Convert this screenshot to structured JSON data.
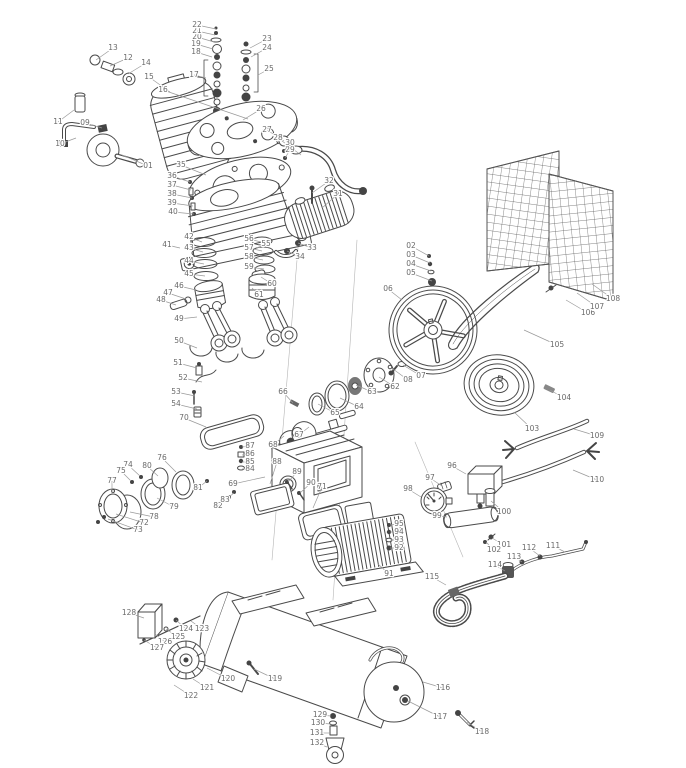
{
  "style": {
    "line_color": "#4a4a4a",
    "label_color": "#6a6a6a",
    "background": "#ffffff",
    "hardware_fill": "#444444"
  },
  "callouts": {
    "fields": [
      "number",
      "label_x",
      "label_y",
      "target_x",
      "target_y"
    ],
    "items": [
      [
        "01",
        148,
        166,
        122,
        155
      ],
      [
        "02",
        411,
        246,
        429,
        256
      ],
      [
        "03",
        411,
        255,
        430,
        263
      ],
      [
        "04",
        411,
        264,
        431,
        271
      ],
      [
        "05",
        411,
        273,
        432,
        281
      ],
      [
        "06",
        388,
        289,
        402,
        300
      ],
      [
        "07",
        421,
        376,
        403,
        365
      ],
      [
        "08",
        408,
        380,
        393,
        369
      ],
      [
        "09",
        85,
        123,
        102,
        128
      ],
      [
        "10",
        60,
        144,
        76,
        138
      ],
      [
        "11",
        58,
        122,
        74,
        110
      ],
      [
        "12",
        128,
        58,
        110,
        66
      ],
      [
        "13",
        113,
        48,
        96,
        60
      ],
      [
        "14",
        146,
        63,
        128,
        74
      ],
      [
        "15",
        149,
        77,
        170,
        92
      ],
      [
        "16",
        163,
        90,
        248,
        119
      ],
      [
        "17",
        194,
        75,
        206,
        78
      ],
      [
        "18",
        196,
        52,
        212,
        57
      ],
      [
        "19",
        196,
        44,
        213,
        49
      ],
      [
        "20",
        197,
        37,
        214,
        42
      ],
      [
        "21",
        197,
        31,
        215,
        35
      ],
      [
        "22",
        197,
        25,
        216,
        29
      ],
      [
        "23",
        267,
        39,
        250,
        48
      ],
      [
        "24",
        267,
        48,
        251,
        57
      ],
      [
        "25",
        269,
        69,
        258,
        75
      ],
      [
        "26",
        261,
        109,
        243,
        120
      ],
      [
        "27",
        267,
        130,
        284,
        141
      ],
      [
        "28",
        278,
        138,
        301,
        155
      ],
      [
        "29",
        290,
        150,
        285,
        158
      ],
      [
        "30",
        290,
        143,
        284,
        151
      ],
      [
        "31",
        338,
        194,
        322,
        208
      ],
      [
        "32",
        329,
        181,
        312,
        193
      ],
      [
        "33",
        312,
        248,
        298,
        243
      ],
      [
        "34",
        300,
        257,
        287,
        251
      ],
      [
        "35",
        181,
        165,
        206,
        175
      ],
      [
        "36",
        172,
        176,
        190,
        182
      ],
      [
        "37",
        172,
        185,
        191,
        190
      ],
      [
        "38",
        172,
        194,
        192,
        198
      ],
      [
        "39",
        172,
        203,
        193,
        206
      ],
      [
        "40",
        173,
        212,
        194,
        214
      ],
      [
        "41",
        167,
        245,
        180,
        248
      ],
      [
        "42",
        189,
        237,
        202,
        242
      ],
      [
        "43",
        189,
        248,
        203,
        252
      ],
      [
        "44",
        189,
        261,
        204,
        264
      ],
      [
        "45",
        189,
        274,
        205,
        276
      ],
      [
        "46",
        179,
        286,
        196,
        290
      ],
      [
        "47",
        168,
        293,
        186,
        299
      ],
      [
        "48",
        161,
        300,
        176,
        305
      ],
      [
        "49",
        179,
        319,
        197,
        317
      ],
      [
        "50",
        179,
        341,
        197,
        348
      ],
      [
        "51",
        178,
        363,
        197,
        368
      ],
      [
        "52",
        183,
        378,
        202,
        382
      ],
      [
        "53",
        176,
        392,
        195,
        396
      ],
      [
        "54",
        176,
        404,
        197,
        409
      ],
      [
        "55",
        266,
        244,
        257,
        248
      ],
      [
        "56",
        249,
        239,
        261,
        242
      ],
      [
        "57",
        249,
        248,
        262,
        251
      ],
      [
        "58",
        249,
        257,
        263,
        260
      ],
      [
        "59",
        249,
        267,
        264,
        269
      ],
      [
        "60",
        272,
        284,
        261,
        277
      ],
      [
        "61",
        259,
        295,
        252,
        288
      ],
      [
        "62",
        395,
        387,
        379,
        377
      ],
      [
        "63",
        372,
        392,
        356,
        385
      ],
      [
        "64",
        359,
        407,
        340,
        398
      ],
      [
        "65",
        335,
        413,
        318,
        404
      ],
      [
        "66",
        283,
        392,
        293,
        403
      ],
      [
        "67",
        299,
        435,
        309,
        427
      ],
      [
        "68",
        273,
        445,
        284,
        436
      ],
      [
        "69",
        233,
        484,
        265,
        477
      ],
      [
        "70",
        184,
        418,
        206,
        427
      ],
      [
        "71",
        322,
        487,
        313,
        508
      ],
      [
        "72",
        144,
        523,
        116,
        514
      ],
      [
        "73",
        138,
        530,
        108,
        519
      ],
      [
        "74",
        128,
        465,
        140,
        476
      ],
      [
        "75",
        121,
        471,
        131,
        481
      ],
      [
        "76",
        162,
        458,
        176,
        472
      ],
      [
        "77",
        112,
        481,
        112,
        494
      ],
      [
        "78",
        154,
        517,
        130,
        512
      ],
      [
        "79",
        174,
        507,
        157,
        498
      ],
      [
        "80",
        147,
        466,
        158,
        476
      ],
      [
        "81",
        198,
        488,
        207,
        481
      ],
      [
        "82",
        218,
        506,
        229,
        497
      ],
      [
        "83",
        225,
        500,
        234,
        493
      ],
      [
        "84",
        250,
        469,
        242,
        469
      ],
      [
        "85",
        250,
        462,
        242,
        462
      ],
      [
        "86",
        250,
        454,
        242,
        455
      ],
      [
        "87",
        250,
        446,
        242,
        447
      ],
      [
        "88",
        277,
        462,
        270,
        484
      ],
      [
        "89",
        297,
        472,
        288,
        482
      ],
      [
        "90",
        311,
        483,
        300,
        493
      ],
      [
        "91",
        389,
        574,
        378,
        564
      ],
      [
        "92",
        399,
        548,
        390,
        548
      ],
      [
        "93",
        399,
        540,
        390,
        540
      ],
      [
        "94",
        399,
        532,
        390,
        532
      ],
      [
        "95",
        399,
        524,
        390,
        525
      ],
      [
        "96",
        452,
        466,
        466,
        474
      ],
      [
        "97",
        430,
        478,
        442,
        486
      ],
      [
        "98",
        408,
        489,
        421,
        497
      ],
      [
        "99",
        437,
        516,
        447,
        517
      ],
      [
        "100",
        504,
        512,
        491,
        501
      ],
      [
        "101",
        504,
        545,
        492,
        538
      ],
      [
        "102",
        494,
        550,
        486,
        542
      ],
      [
        "103",
        532,
        429,
        514,
        412
      ],
      [
        "104",
        564,
        398,
        550,
        390
      ],
      [
        "105",
        557,
        345,
        524,
        330
      ],
      [
        "106",
        588,
        313,
        566,
        300
      ],
      [
        "107",
        597,
        307,
        577,
        293
      ],
      [
        "108",
        613,
        299,
        592,
        284
      ],
      [
        "109",
        597,
        436,
        574,
        429
      ],
      [
        "110",
        597,
        480,
        573,
        470
      ],
      [
        "111",
        553,
        546,
        565,
        552
      ],
      [
        "112",
        529,
        548,
        540,
        556
      ],
      [
        "113",
        514,
        557,
        522,
        562
      ],
      [
        "114",
        495,
        565,
        505,
        571
      ],
      [
        "115",
        432,
        577,
        446,
        585
      ],
      [
        "116",
        443,
        688,
        423,
        682
      ],
      [
        "117",
        440,
        717,
        408,
        701
      ],
      [
        "118",
        482,
        732,
        467,
        722
      ],
      [
        "119",
        275,
        679,
        254,
        669
      ],
      [
        "120",
        228,
        679,
        207,
        668
      ],
      [
        "121",
        207,
        688,
        193,
        679
      ],
      [
        "122",
        191,
        696,
        174,
        685
      ],
      [
        "123",
        202,
        629,
        191,
        621
      ],
      [
        "124",
        186,
        629,
        176,
        620
      ],
      [
        "125",
        178,
        637,
        166,
        629
      ],
      [
        "126",
        165,
        642,
        155,
        634
      ],
      [
        "127",
        157,
        648,
        144,
        640
      ],
      [
        "128",
        129,
        613,
        144,
        618
      ],
      [
        "129",
        320,
        715,
        331,
        716
      ],
      [
        "130",
        318,
        723,
        331,
        724
      ],
      [
        "131",
        317,
        733,
        331,
        733
      ],
      [
        "132",
        317,
        743,
        327,
        747
      ]
    ]
  }
}
